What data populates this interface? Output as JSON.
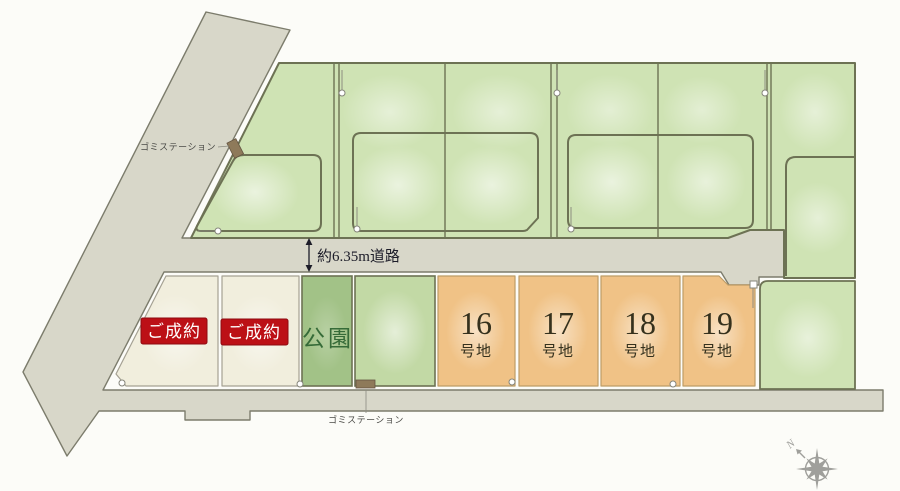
{
  "map": {
    "road_label": "約6.35m道路",
    "trash_station_top": "ゴミステーション",
    "trash_station_bottom": "ゴミステーション",
    "park_label": "公園",
    "sold_plots": [
      {
        "status": "ご成約"
      },
      {
        "status": "ご成約"
      }
    ],
    "numbered_lots": [
      {
        "number": "16",
        "suffix": "号地"
      },
      {
        "number": "17",
        "suffix": "号地"
      },
      {
        "number": "18",
        "suffix": "号地"
      },
      {
        "number": "19",
        "suffix": "号地"
      }
    ],
    "compass": {
      "north_label": "N"
    }
  },
  "colors": {
    "background": "#fcfcf8",
    "road_fill": "#d8d7c9",
    "road_stroke": "#7c7c6c",
    "green_base": "#cfe3b4",
    "plot_stroke": "#6d7254",
    "cream_fill": "#f1eedd",
    "cream_stroke": "#a5a193",
    "park_fill": "#a2c287",
    "park_text": "#366b38",
    "lightgreen_fill": "#c2d9a5",
    "orange_fill": "#f0c286",
    "orange_stroke": "#bd9c66",
    "lot_text": "#35311d",
    "badge_bg": "#bc1016",
    "badge_stroke": "#8e0a10",
    "badge_text": "#ffffff",
    "dim_text": "#1d1d29",
    "small_text": "#4a4a46",
    "leader": "#8b8b80",
    "trash_fill": "#8e7a5a",
    "trash_stroke": "#645441",
    "compass": "#8f8f8b",
    "marker_fill": "#ffffff",
    "marker_stroke": "#85857a"
  }
}
